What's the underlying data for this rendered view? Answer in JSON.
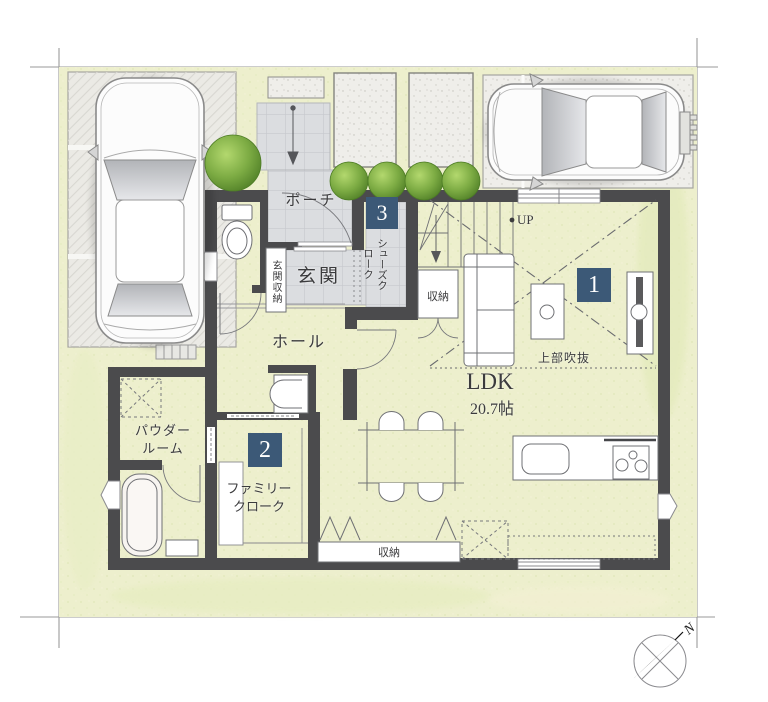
{
  "rooms": {
    "porch": "ポーチ",
    "entrance": "玄関",
    "entrance_storage": "玄関収納",
    "shoes_cloak": "シューズクローク",
    "stair_storage": "収納",
    "hall": "ホール",
    "ldk_name": "LDK",
    "ldk_size": "20.7帖",
    "void_above": "上部吹抜",
    "up": "UP",
    "powder_line1": "パウダー",
    "powder_line2": "ルーム",
    "family_line1": "ファミリー",
    "family_line2": "クローク",
    "ldk_storage": "収納"
  },
  "badges": {
    "ldk": "1",
    "family_cloak": "2",
    "shoes_cloak": "3"
  },
  "compass": {
    "north_label": "N"
  },
  "colors": {
    "badge_bg": "#3c5977",
    "wall": "#4b4b4d",
    "tile": "#dbdde0",
    "lawn": "#edefcd",
    "bush_green": "#6fa23c",
    "pad_gray": "#eceae6"
  }
}
